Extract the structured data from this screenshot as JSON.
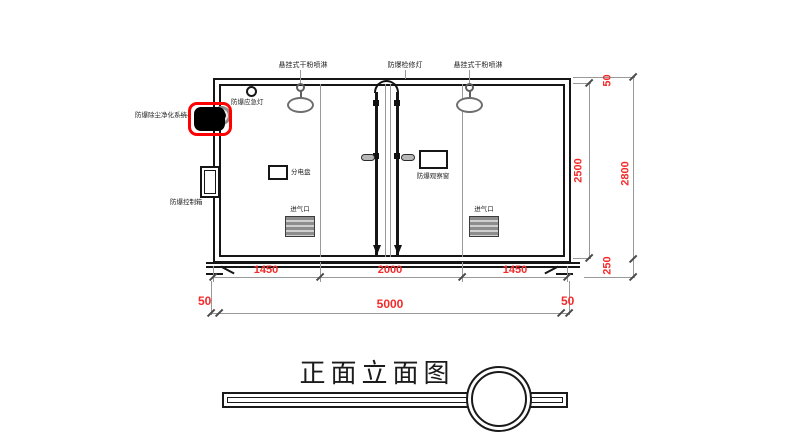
{
  "title": "正面立面图",
  "colors": {
    "dimension_text": "#f52a2a",
    "highlight_box": "#ff0000",
    "drawing_line": "#1a1a1a"
  },
  "equipment": {
    "sprinkler_left": "悬挂式干粉喷淋",
    "inspection_light": "防爆检修灯",
    "sprinkler_right": "悬挂式干粉喷淋",
    "emergency_light": "防爆应急灯",
    "purification_system": "防爆除尘净化系统",
    "control_box": "防爆控制箱",
    "distribution_panel": "分电盘",
    "observation_window": "防爆观察窗",
    "air_inlet_left": "进气口",
    "air_inlet_right": "进气口"
  },
  "dimensions": {
    "bottom_segments": [
      "1450",
      "2000",
      "1450"
    ],
    "wall_left": "50",
    "overall_width": "5000",
    "wall_right": "50",
    "roof": "50",
    "interior_height": "2500",
    "base": "250",
    "overall_height": "2800"
  }
}
